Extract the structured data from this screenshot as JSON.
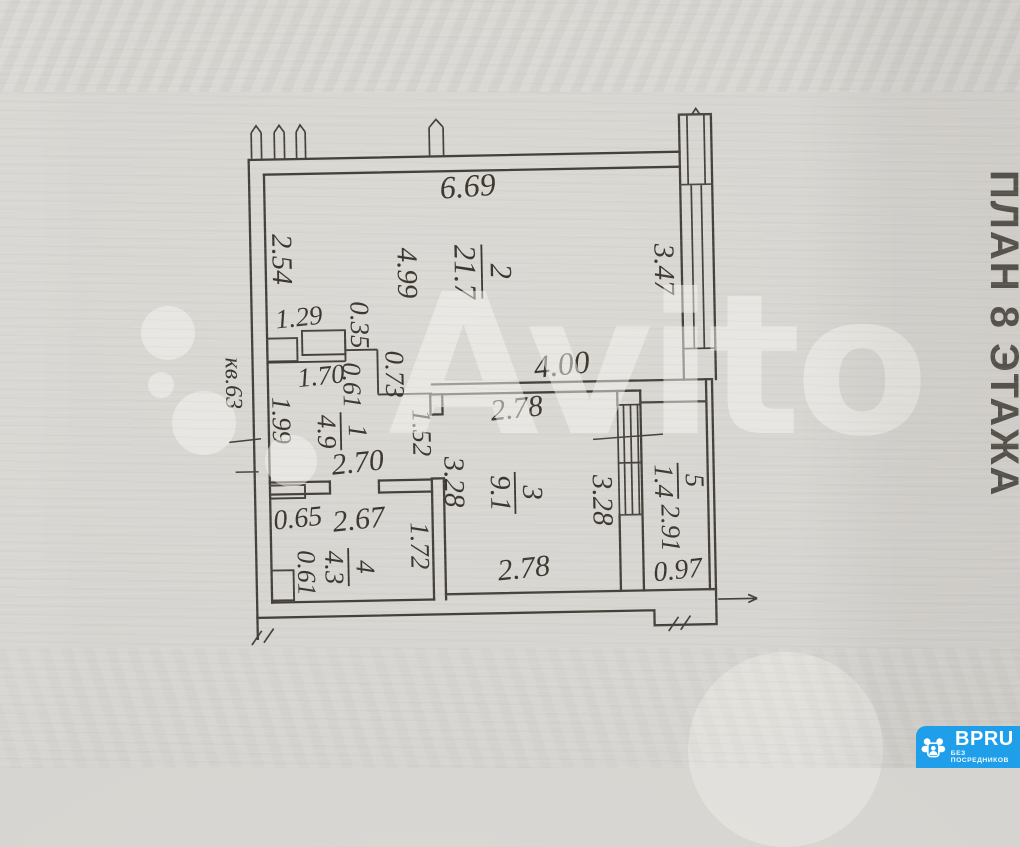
{
  "plan": {
    "apartment_label": "кв.63",
    "rooms": [
      {
        "number": "2",
        "area": "21.7"
      },
      {
        "number": "1",
        "area": "4.9"
      },
      {
        "number": "3",
        "area": "9.1"
      },
      {
        "number": "4",
        "area": "4.3"
      },
      {
        "number": "5",
        "area": "1.4"
      }
    ],
    "dims": {
      "top_width": "6.69",
      "left_upper": "2.54",
      "room2_depth": "4.99",
      "right_window": "3.47",
      "closet_run": "1.29",
      "closet_depth": "0.35",
      "wall_jog": "0.73",
      "hall_top": "1.70",
      "hall_nook": "0.61",
      "left_lower": "1.99",
      "inner_wall": "4.00",
      "room1_width": "2.70",
      "opening": "1.52",
      "room3_top": "2.78",
      "room3_left": "3.28",
      "room3_right": "3.28",
      "room3_bottom": "2.78",
      "bath_nook": "0.65",
      "bath_width": "2.67",
      "bath_depth": "1.72",
      "shaft_width": "0.61",
      "balcony_length": "2.91",
      "balcony_width": "0.97"
    }
  },
  "watermark": {
    "text": "Avito"
  },
  "side_caption": "ПЛАН 8 ЭТАЖА",
  "badge": {
    "brand": "BPRU",
    "tagline": "БЕЗ ПОСРЕДНИКОВ",
    "background": "#1f9ee9"
  }
}
